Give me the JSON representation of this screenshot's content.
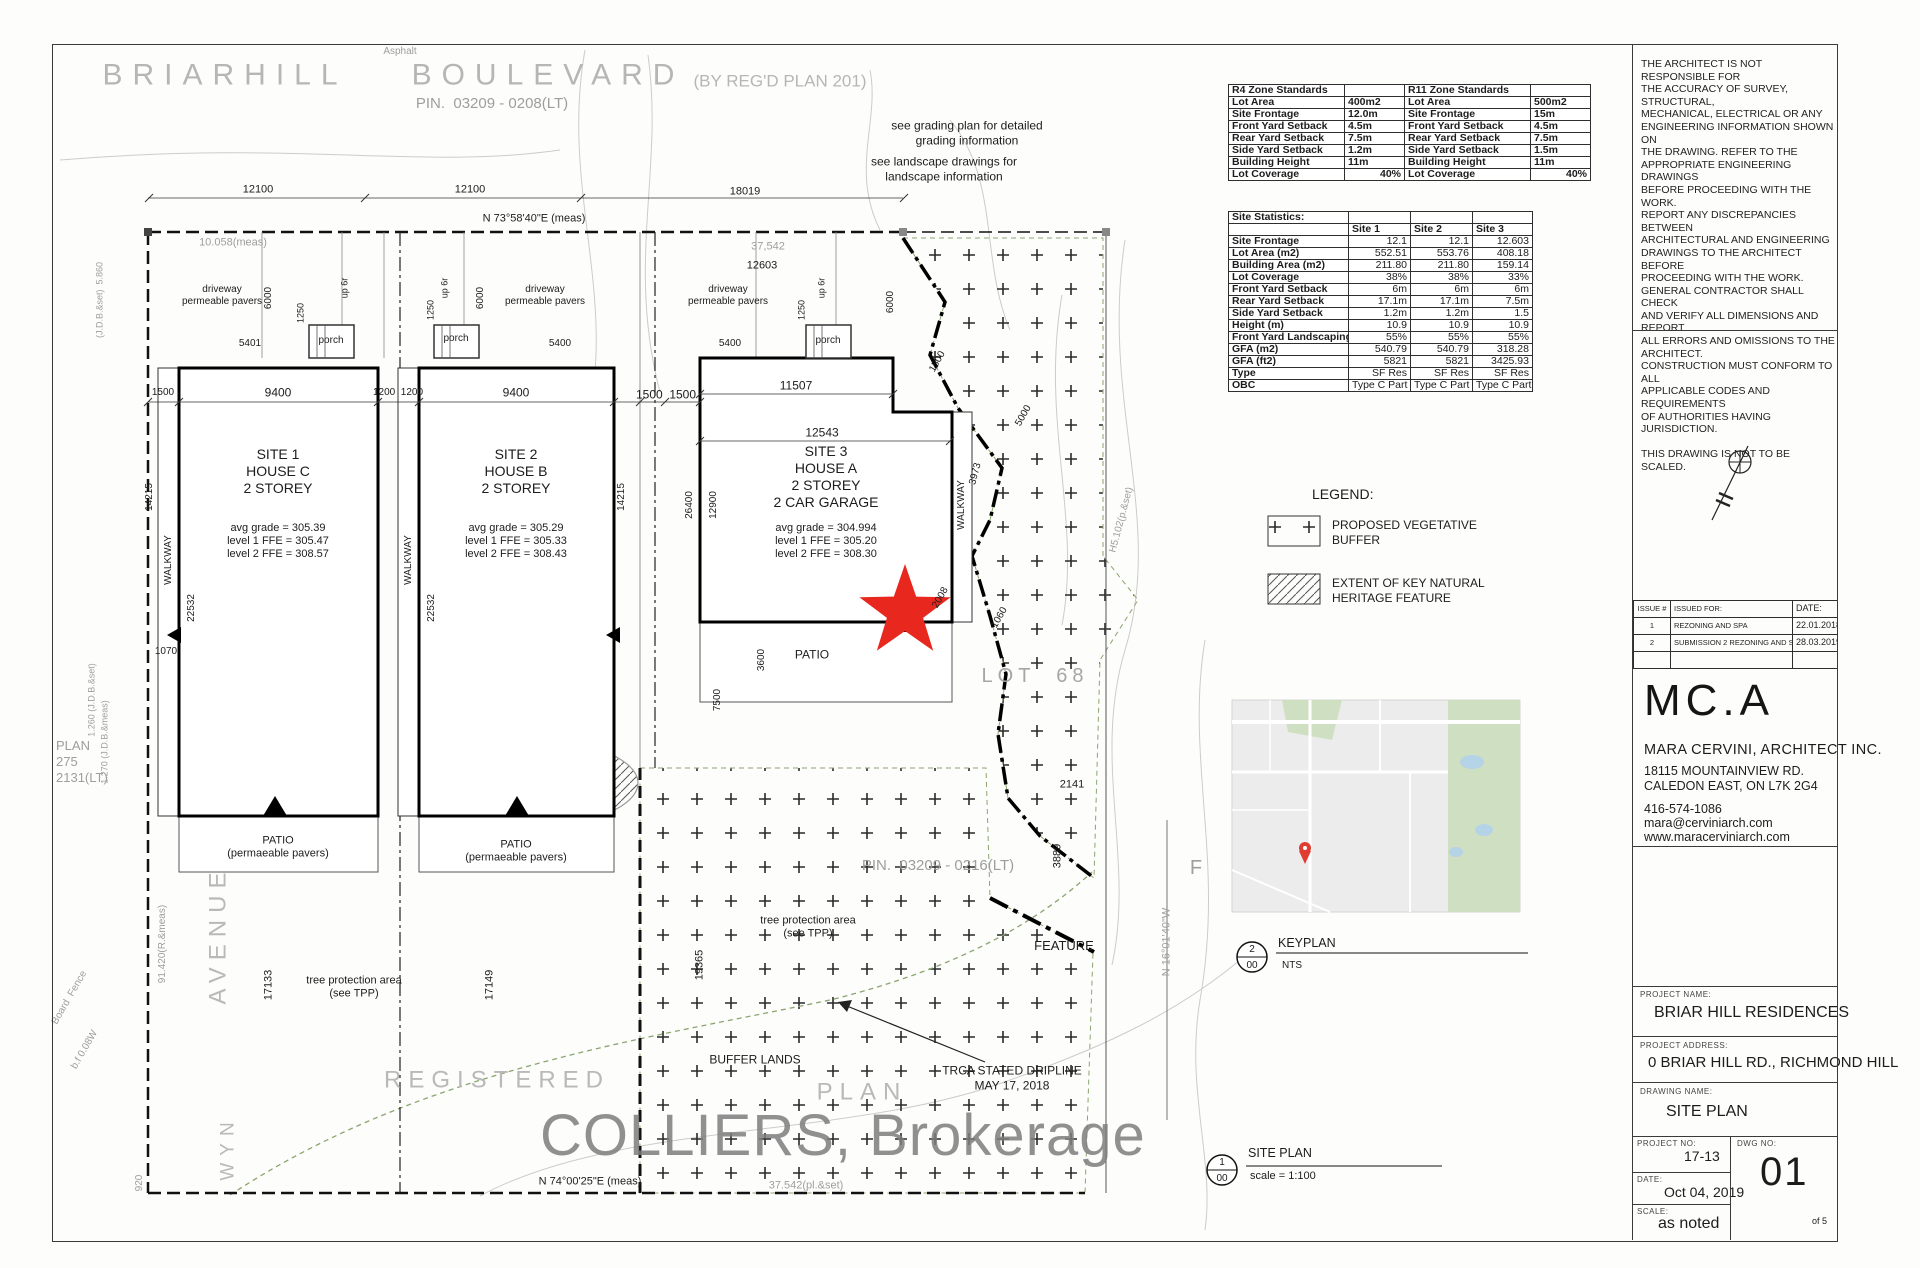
{
  "street": {
    "name1": "BRIARHILL",
    "name2": "BOULEVARD",
    "plan_ref": "(BY REG'D PLAN 201)",
    "pin": "PIN.  03209 - 0208(LT)"
  },
  "notes": {
    "grading": [
      "see grading plan for detailed",
      "grading information"
    ],
    "landscape": [
      "see landscape drawings for",
      "landscape information"
    ]
  },
  "zone_tables": {
    "r4_rows": [
      [
        "R4 Zone Standards",
        ""
      ],
      [
        "Lot Area",
        "400m2"
      ],
      [
        "Site Frontage",
        "12.0m"
      ],
      [
        "Front Yard Setback",
        "4.5m"
      ],
      [
        "Rear Yard Setback",
        "7.5m"
      ],
      [
        "Side Yard Setback",
        "1.2m"
      ],
      [
        "Building Height",
        "11m"
      ],
      [
        "Lot Coverage",
        "40%"
      ]
    ],
    "r11_rows": [
      [
        "R11 Zone Standards",
        ""
      ],
      [
        "Lot Area",
        "500m2"
      ],
      [
        "Site Frontage",
        "15m"
      ],
      [
        "Front Yard Setback",
        "4.5m"
      ],
      [
        "Rear Yard Setback",
        "7.5m"
      ],
      [
        "Side Yard Setback",
        "1.5m"
      ],
      [
        "Building Height",
        "11m"
      ],
      [
        "Lot Coverage",
        "40%"
      ]
    ]
  },
  "site_stats_rows": [
    [
      "Site Statistics:",
      "",
      "",
      ""
    ],
    [
      "",
      "Site 1",
      "Site 2",
      "Site 3"
    ],
    [
      "Site Frontage",
      "12.1",
      "12.1",
      "12.603"
    ],
    [
      "Lot Area  (m2)",
      "552.51",
      "553.76",
      "408.18"
    ],
    [
      "Building Area (m2)",
      "211.80",
      "211.80",
      "159.14"
    ],
    [
      "Lot Coverage",
      "38%",
      "38%",
      "33%"
    ],
    [
      "Front Yard Setback",
      "6m",
      "6m",
      "6m"
    ],
    [
      "Rear Yard Setback",
      "17.1m",
      "17.1m",
      "7.5m"
    ],
    [
      "Side Yard Setback",
      "1.2m",
      "1.2m",
      "1.5"
    ],
    [
      "Height (m)",
      "10.9",
      "10.9",
      "10.9"
    ],
    [
      "Front Yard Landscaping (%)",
      "55%",
      "55%",
      "55%"
    ],
    [
      "GFA (m2)",
      "540.79",
      "540.79",
      "318.28"
    ],
    [
      "GFA (ft2)",
      "5821",
      "5821",
      "3425.93"
    ],
    [
      "Type",
      "SF Res",
      "SF Res",
      "SF Res"
    ],
    [
      "OBC",
      "Type C Part 9",
      "Type C Part 9",
      "Type C Part 9"
    ]
  ],
  "legend": {
    "title": "LEGEND:",
    "item1": [
      "PROPOSED VEGETATIVE",
      "BUFFER"
    ],
    "item2": [
      "EXTENT OF KEY NATURAL",
      "HERITAGE FEATURE"
    ]
  },
  "keyplan": {
    "num": "2",
    "sheet": "00",
    "label": "KEYPLAN",
    "scale": "NTS"
  },
  "siteplan_ref": {
    "num": "1",
    "sheet": "00",
    "label": "SITE PLAN",
    "scale": "scale = 1:100"
  },
  "sites": [
    {
      "title": "SITE 1",
      "house": "HOUSE C",
      "storey": "2 STOREY",
      "grades": [
        "avg grade = 305.39",
        "level 1 FFE = 305.47",
        "level 2 FFE = 308.57"
      ]
    },
    {
      "title": "SITE 2",
      "house": "HOUSE B",
      "storey": "2 STOREY",
      "grades": [
        "avg grade = 305.29",
        "level 1 FFE = 305.33",
        "level 2 FFE = 308.43"
      ]
    },
    {
      "title": "SITE 3",
      "house": "HOUSE A",
      "storey": "2 STOREY",
      "garage": "2 CAR GARAGE",
      "grades": [
        "avg grade = 304.994",
        "level 1 FFE = 305.20",
        "level 2 FFE = 308.30"
      ]
    }
  ],
  "plan_labels": {
    "asphalt": "Asphalt",
    "d12100a": "12100",
    "d12100b": "12100",
    "d18019": "18019",
    "bearing_top": "N 73°58'40\"E (meas)",
    "d10058": "10.058(meas)",
    "d37542a": "37,542",
    "d12603": "12603",
    "d6000a": "6000",
    "d6000b": "6000",
    "d6000c": "6000",
    "drv1": [
      "driveway",
      "permeable pavers"
    ],
    "drv2": [
      "driveway",
      "permeable pavers"
    ],
    "drv3": [
      "driveway",
      "permeable pavers"
    ],
    "up6r1": "up 6r",
    "up6r2": "up 6r",
    "up6r3": "up 6r",
    "d1250a": "1250",
    "d1250b": "1250",
    "d1250c": "1250",
    "porch1": "porch",
    "porch2": "porch",
    "porch3": "porch",
    "d5401": "5401",
    "d5400a": "5400",
    "d5400b": "5400",
    "d1500l": "1500",
    "d9400a": "9400",
    "d1200p": "1200  1200",
    "d9400b": "9400",
    "d1500p": "1500  1500",
    "d11507": "11507",
    "d12543": "12543",
    "d1500d": "1500",
    "d3973": "3973",
    "d5000": "5000",
    "d1060": "1060",
    "d2008": "2008",
    "walkway1": "WALKWAY",
    "walkway2": "WALKWAY",
    "walkway3": "WALKWAY",
    "d14215a": "14215",
    "d14215b": "14215",
    "d22532a": "22532",
    "d22532b": "22532",
    "d26400": "26400",
    "d12900": "12900",
    "d7500": "7500",
    "d3600": "3600",
    "patio3": "PATIO",
    "patio1": [
      "PATIO",
      "(permaeable pavers)"
    ],
    "patio2": [
      "PATIO",
      "(permaeable pavers)"
    ],
    "d1070": "1070",
    "d2141": "2141",
    "d3889": "3889",
    "d19365": "19365",
    "d17133": "17133",
    "d17149": "17149",
    "d91420": "91.420(R.&meas)",
    "lot68": "LOT  68",
    "pin_mid": "PIN.  03209 - 0216(LT)",
    "tpp1": [
      "tree protection area",
      "(see TPP)"
    ],
    "tpp2": [
      "tree protection area",
      "(see TPP)"
    ],
    "buffer_lands": "BUFFER LANDS",
    "feature": "FEATURE",
    "trca": [
      "TRCA STATED DRIPLINE",
      "MAY 17, 2018"
    ],
    "registered": "REGISTERED",
    "plan_word": "PLAN",
    "avenue": "AVENUE",
    "wyn": "WYN",
    "plan275": [
      "PLAN",
      "275",
      "2131(LT)"
    ],
    "jdb1": "(J.D.B.&set)  5.860",
    "jdb2": "1.260 (J.D.B.&set)",
    "jdb3": "1.270 (J.D.B.&meas)",
    "bf1": "Board  Fence",
    "bf2": "b.f 0.08W",
    "d920": "920",
    "bearing_bot": "N 74°00'25\"E (meas)",
    "d37542b": "37.542(pl.&set)",
    "n16": "N 16°01'40\"W",
    "h5102": "H5.102(p.&set)",
    "fgray": "F"
  },
  "watermark": "COLLIERS, Brokerage",
  "titleblock": {
    "disclaimer": [
      "THE ARCHITECT IS NOT RESPONSIBLE FOR",
      "THE ACCURACY OF SURVEY, STRUCTURAL,",
      "MECHANICAL, ELECTRICAL OR ANY",
      "ENGINEERING INFORMATION SHOWN ON",
      "THE DRAWING.  REFER TO THE",
      "APPROPRIATE ENGINEERING DRAWINGS",
      "BEFORE PROCEEDING WITH THE WORK.",
      "REPORT ANY DISCREPANCIES BETWEEN",
      "ARCHITECTURAL AND ENGINEERING",
      "DRAWINGS TO THE ARCHITECT BEFORE",
      "PROCEEDING WITH THE WORK.",
      "GENERAL CONTRACTOR SHALL CHECK",
      "AND VERIFY ALL DIMENSIONS AND REPORT",
      "ALL ERRORS AND OMISSIONS TO THE",
      "ARCHITECT.",
      "CONSTRUCTION MUST CONFORM TO ALL",
      "APPLICABLE CODES AND REQUIREMENTS",
      "OF AUTHORITIES HAVING JURISDICTION.",
      "",
      "THIS DRAWING IS NOT TO BE SCALED."
    ],
    "issues_header_num": "ISSUE #",
    "issues_header_for": "ISSUED FOR:",
    "issues_header_date": "DATE:",
    "issues_rows": [
      [
        "1",
        "REZONING  AND SPA",
        "22.01.2018"
      ],
      [
        "2",
        "SUBMISSION 2 REZONING  AND SPA",
        "28.03.2019"
      ],
      [
        "",
        "",
        ""
      ]
    ],
    "firm": {
      "logo": "MC.A",
      "name": "MARA CERVINI, ARCHITECT INC.",
      "addr1": "18115 MOUNTAINVIEW RD.",
      "addr2": "CALEDON EAST, ON L7K 2G4",
      "phone": "416-574-1086",
      "email": "mara@cerviniarch.com",
      "web": "www.maracerviniarch.com"
    },
    "project": {
      "name_label": "PROJECT NAME:",
      "name": "BRIAR HILL RESIDENCES",
      "addr_label": "PROJECT ADDRESS:",
      "addr": "0 BRIAR HILL RD., RICHMOND HILL",
      "dwg_label": "DRAWING NAME:",
      "dwg": "SITE PLAN",
      "no_label": "PROJECT NO:",
      "no": "17-13",
      "date_label": "DATE:",
      "date": "Oct 04, 2019",
      "scale_label": "SCALE:",
      "scale": "as noted",
      "dwgno_label": "DWG NO:",
      "dwgno": "01",
      "of": "of 5"
    }
  }
}
